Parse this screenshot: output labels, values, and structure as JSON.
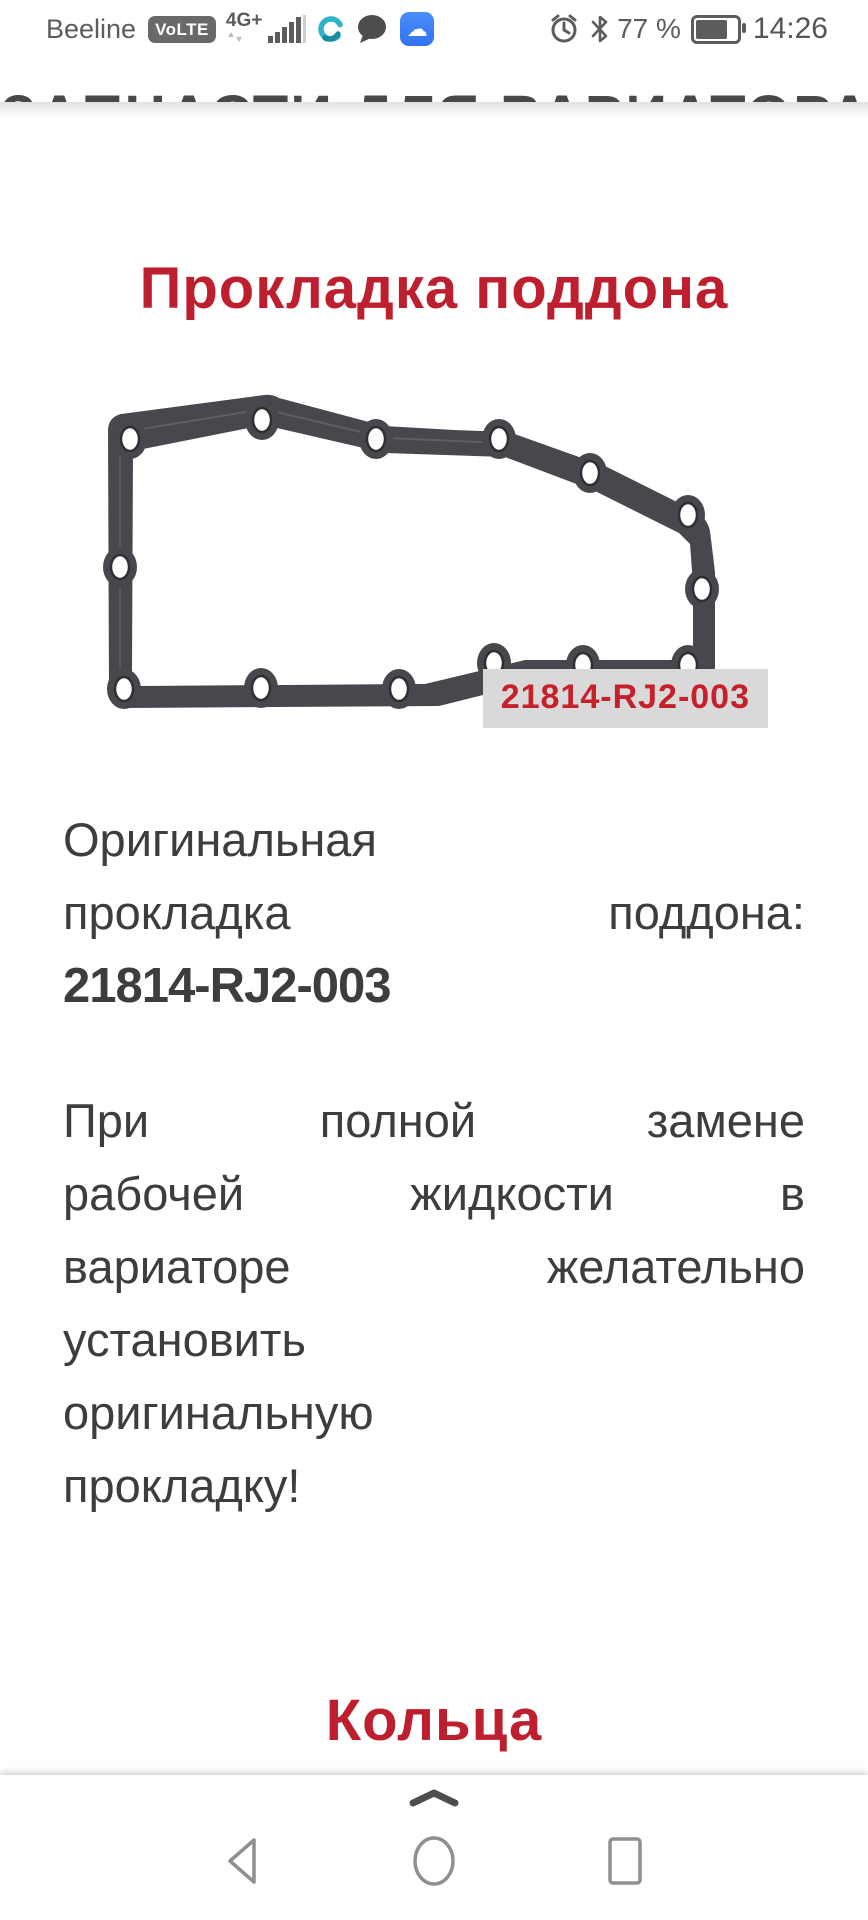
{
  "status_bar": {
    "carrier": "Beeline",
    "volte_badge": "VoLTE",
    "network_type": "4G+",
    "battery_percent": "77 %",
    "time": "14:26",
    "icons": [
      "updown-arrows-icon",
      "signal-bars-icon",
      "app-ring-icon",
      "chat-bubble-icon",
      "cloud-app-icon",
      "alarm-clock-icon",
      "bluetooth-icon",
      "battery-icon"
    ],
    "cloud_glyph": "☁"
  },
  "page": {
    "cutoff_heading": "ЗАПЧАСТИ ДЛЯ ВАРИАТОРА",
    "title": "Прокладка поддона",
    "image_label": "21814-RJ2-003",
    "paragraph1_lines": [
      {
        "words": [
          "Оригинальная"
        ],
        "bold": false
      },
      {
        "words": [
          "прокладка",
          "поддона:"
        ],
        "bold": false
      },
      {
        "words": [
          "21814-RJ2-003"
        ],
        "bold": true
      }
    ],
    "paragraph2_lines": [
      {
        "words": [
          "При",
          "полной",
          "замене"
        ],
        "bold": false
      },
      {
        "words": [
          "рабочей",
          "жидкости",
          "в"
        ],
        "bold": false
      },
      {
        "words": [
          "вариаторе",
          "желательно"
        ],
        "bold": false
      },
      {
        "words": [
          "установить"
        ],
        "bold": false
      },
      {
        "words": [
          "оригинальную"
        ],
        "bold": false
      },
      {
        "words": [
          "прокладку!"
        ],
        "bold": false
      }
    ],
    "section2_title_line1": "Кольца",
    "section2_title_line2": "уплотнительные"
  },
  "navigation": {
    "items": [
      "back-button",
      "home-button",
      "recents-button"
    ],
    "gesture_handle": "chevron-up-handle"
  },
  "colors": {
    "accent_red": "#be1f2e",
    "label_red": "#c6202b",
    "label_background": "#d9d9d9",
    "body_text": "#3d3d3d",
    "statusbar_gray": "#5c5c5c",
    "gasket_dark": "#46484d",
    "cloud_blue": "#3b7ff5",
    "app_ring_teal": "#2cb5c8"
  }
}
